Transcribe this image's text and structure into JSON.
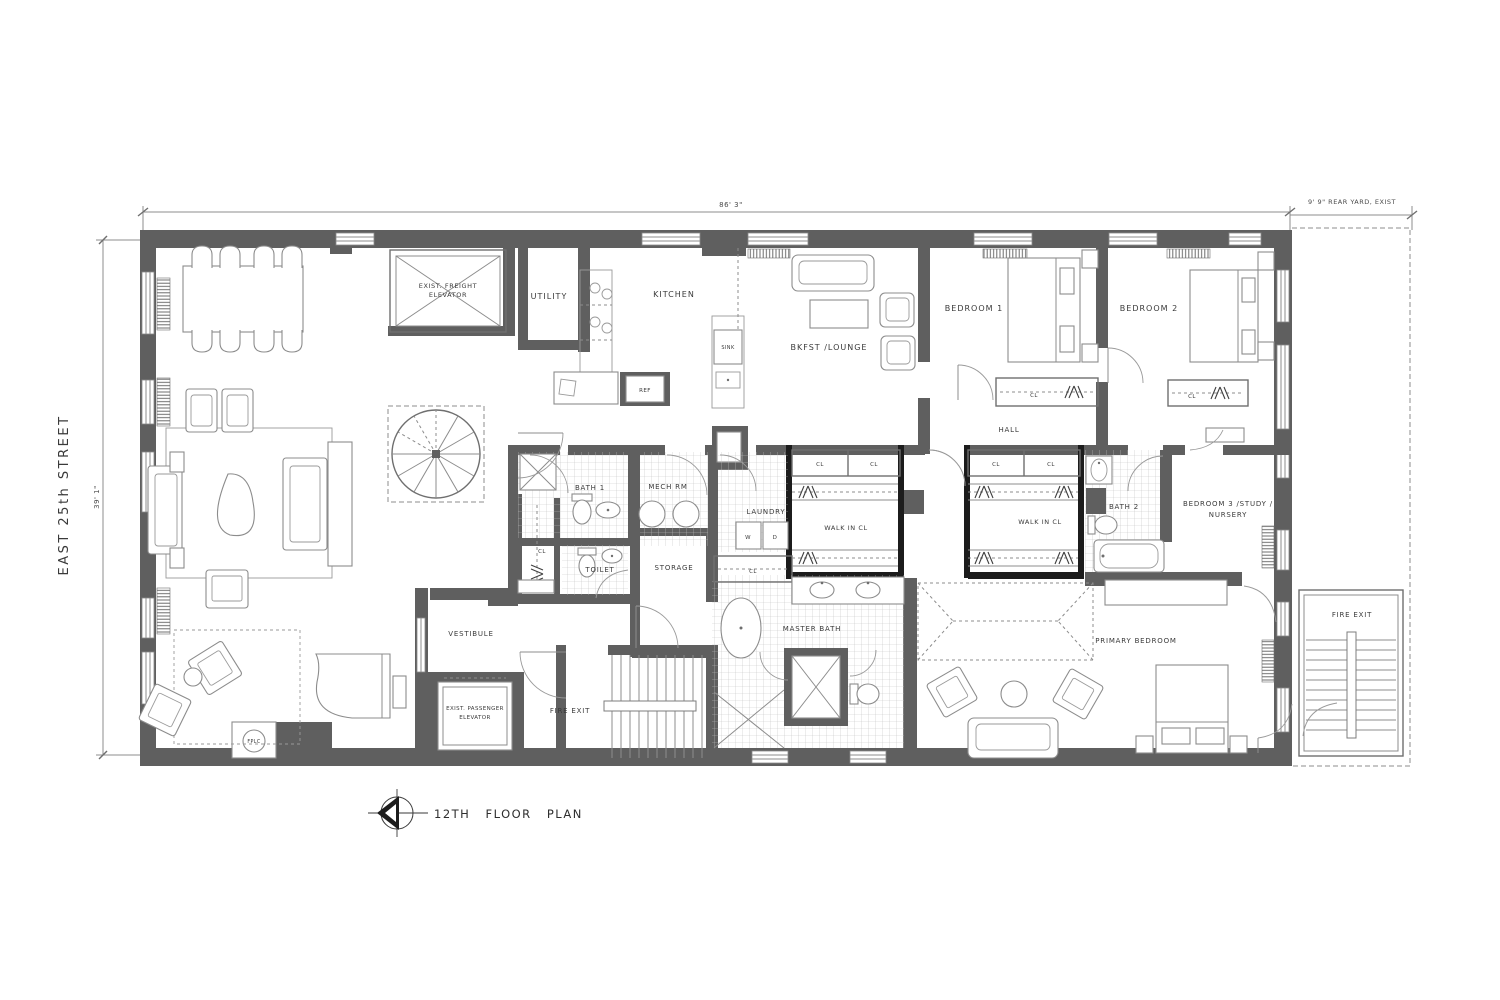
{
  "title": {
    "floor_plan": "12TH FLOOR PLAN"
  },
  "street": "EAST 25th STREET",
  "dims": {
    "width": "86' 3\"",
    "depth": "39' 1\"",
    "rear_yard": "9' 9\" REAR YARD, EXIST"
  },
  "rooms": {
    "freight_line1": "EXIST. FREIGHT",
    "freight_line2": "ELEVATOR",
    "utility": "UTILITY",
    "kitchen": "KITCHEN",
    "bkfst_lounge": "BKFST /LOUNGE",
    "bedroom_1": "BEDROOM 1",
    "bedroom_2": "BEDROOM 2",
    "hall": "HALL",
    "bath_1": "BATH 1",
    "mech_rm": "MECH RM",
    "laundry": "LAUNDRY",
    "walk_in_cl": "WALK IN CL",
    "bath_2": "BATH 2",
    "bedroom_3_line1": "BEDROOM 3 /STUDY /",
    "bedroom_3_line2": "NURSERY",
    "toilet": "TOILET",
    "storage": "STORAGE",
    "vestibule": "VESTIBULE",
    "passenger_line1": "EXIST. PASSENGER",
    "passenger_line2": "ELEVATOR",
    "fire_exit": "FIRE EXIT",
    "master_bath": "MASTER BATH",
    "primary_bedroom": "PRIMARY BEDROOM"
  },
  "labels": {
    "cl": "CL",
    "washer": "W",
    "dryer": "D",
    "sink": "SINK",
    "ref": "REF",
    "fplc": "FPLC"
  },
  "colors": {
    "wall_poche": "#5f5f5f",
    "new_partition": "#1c1c1c",
    "line": "#8c8c8c",
    "background": "#ffffff"
  }
}
